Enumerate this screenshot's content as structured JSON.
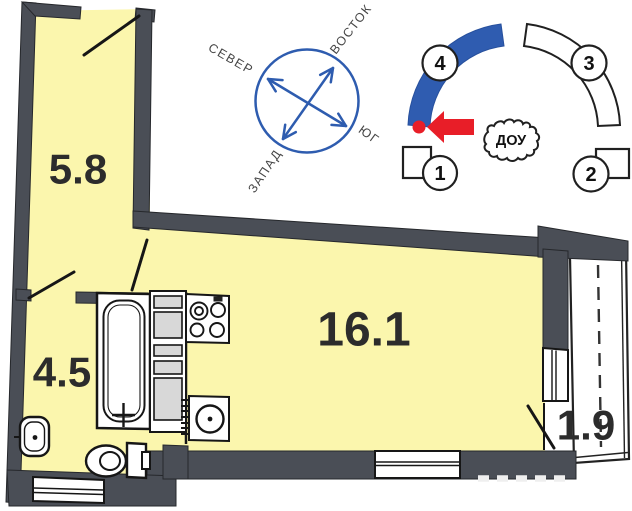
{
  "plan": {
    "rooms": [
      {
        "id": "hallway",
        "area": "5.8"
      },
      {
        "id": "bathroom",
        "area": "4.5"
      },
      {
        "id": "living-kitchen",
        "area": "16.1"
      },
      {
        "id": "balcony",
        "area": "1.9"
      }
    ],
    "compass": {
      "north": "СЕВЕР",
      "east": "ВОСТОК",
      "south": "ЮГ",
      "west": "ЗАПАД"
    },
    "site": {
      "buildings": [
        {
          "label": "1",
          "highlighted": false
        },
        {
          "label": "2",
          "highlighted": false
        },
        {
          "label": "3",
          "highlighted": false
        },
        {
          "label": "4",
          "highlighted": true
        }
      ],
      "annotation": "ДОУ"
    },
    "colors": {
      "wall": "#4a4e56",
      "room_fill": "#fbf6ad",
      "compass_blue": "#2e5caf",
      "highlight_blue": "#2f5cb0",
      "marker_red": "#e81e28",
      "cabinet_gray": "#d8d8d8"
    }
  }
}
